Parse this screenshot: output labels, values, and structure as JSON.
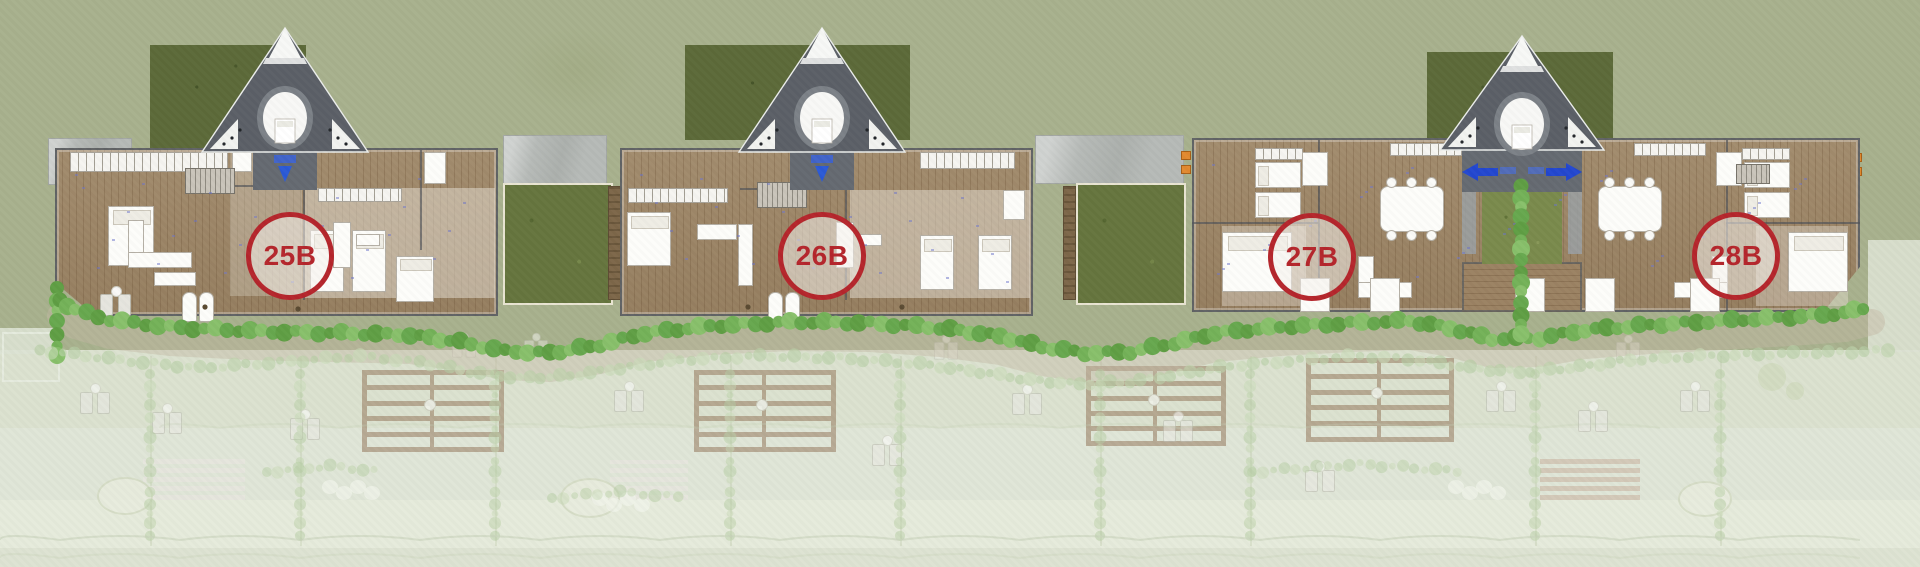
{
  "plan": {
    "units": [
      {
        "label": "25B"
      },
      {
        "label": "26B"
      },
      {
        "label": "27B"
      },
      {
        "label": "28B"
      }
    ],
    "colors": {
      "badge_red": "#b5262c",
      "sage_green": "#a8b18d",
      "pale_lawn": "#e0e6d7",
      "deck_wood": "#9d8565",
      "roof_gray": "#5b6067",
      "garden_green": "#5c6a39",
      "bush_green": "#6fae54",
      "path_gray": "#b6bab7",
      "pin_blue": "#2b59d6",
      "marker_orange": "#e2892f"
    }
  }
}
